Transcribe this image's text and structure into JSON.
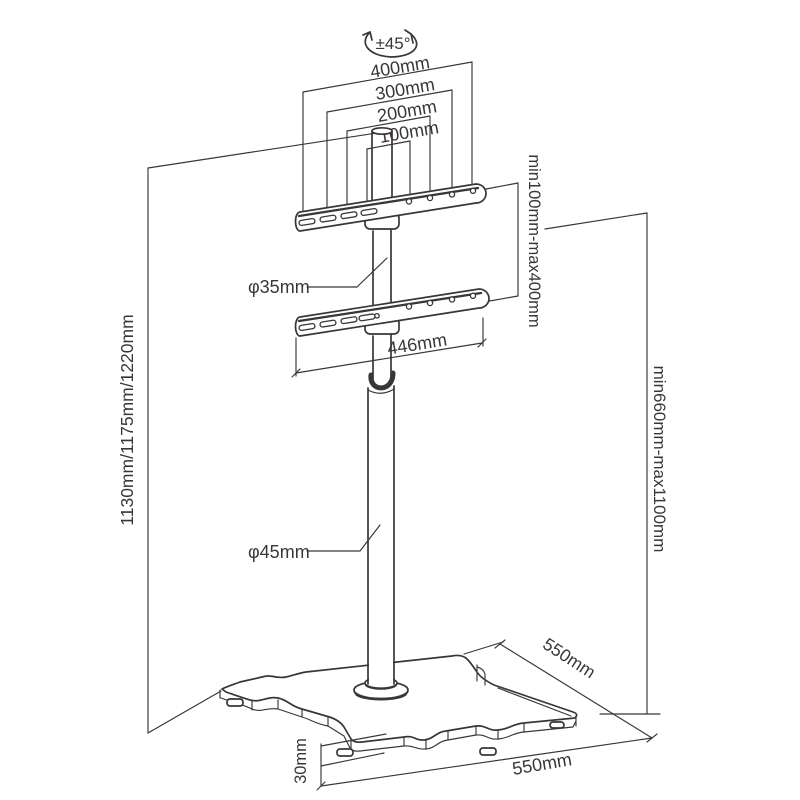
{
  "title": "TV floor stand dimension diagram",
  "colors": {
    "line": "#3a3634",
    "background": "#ffffff"
  },
  "labels": {
    "rotation": "±45°",
    "vesa_400": "400mm",
    "vesa_300": "300mm",
    "vesa_200": "200mm",
    "vesa_100": "100mm",
    "bracket_vertical_range": "min100mm-max400mm",
    "pole_upper_diameter": "φ35mm",
    "bracket_width": "446mm",
    "total_height": "1130mm/1175mm/1220mm",
    "pole_height_range": "min660mm-max1100mm",
    "pole_lower_diameter": "φ45mm",
    "base_depth": "550mm",
    "base_width": "550mm",
    "base_thickness": "30mm"
  }
}
